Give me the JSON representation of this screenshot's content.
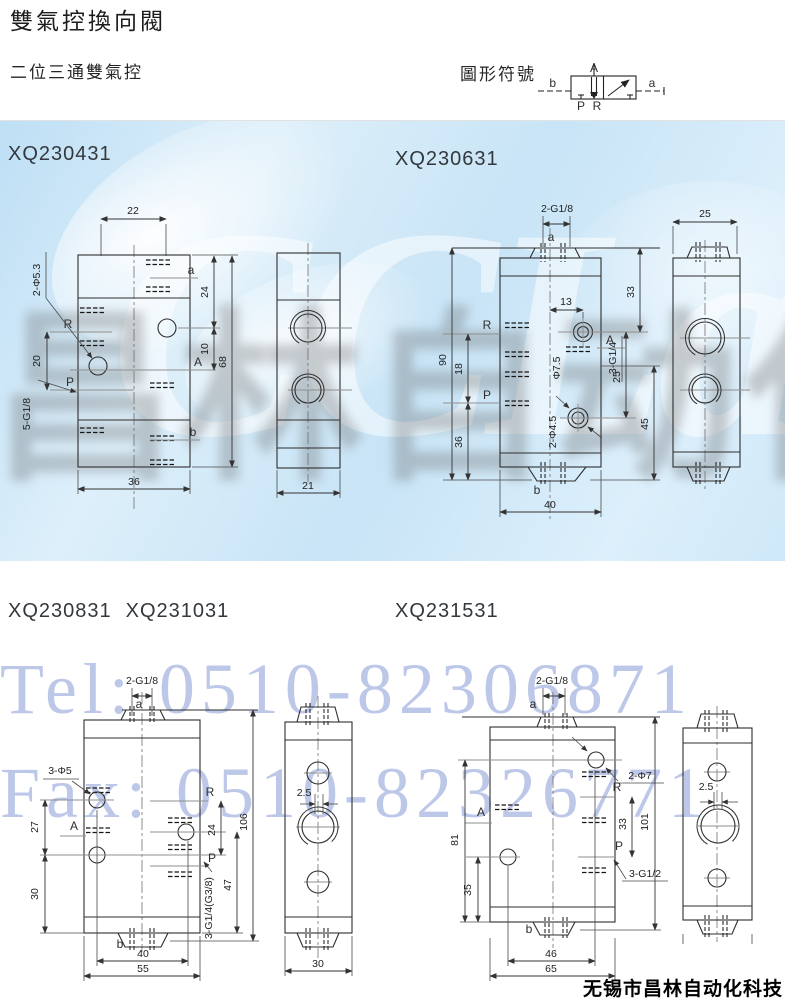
{
  "page": {
    "title": "雙氣控換向閥",
    "subtitle": "二位三通雙氣控",
    "symbol_title": "圖形符號",
    "footer": "无锡市昌林自动化科技",
    "watermark": {
      "tel": "Tel: 0510-82306871",
      "fax": "Fax: 0510-82326771",
      "brand": "CCLair",
      "brand_cn": "昌林自动化"
    }
  },
  "symbol": {
    "a": "a",
    "b": "b",
    "A": "A",
    "P": "P",
    "R": "R"
  },
  "models": [
    {
      "label": "XQ230431",
      "front": {
        "w_top": "22",
        "holes": "2-Φ5.3",
        "d24": "24",
        "d10": "10",
        "d68": "68",
        "d20": "20",
        "thread": "5-G1/8",
        "w_bot": "36",
        "R": "R",
        "P": "P",
        "A": "A",
        "a": "a",
        "b": "b"
      },
      "side": {
        "w": "21"
      }
    },
    {
      "label": "XQ230631",
      "front": {
        "top": "2-G1/8",
        "a": "a",
        "d33": "33",
        "d13": "13",
        "R": "R",
        "A": "A",
        "thread": "3-G1/4",
        "d25": "25",
        "d90": "90",
        "d18": "18",
        "P": "P",
        "cbore": "Φ7.5",
        "holes": "2-Φ4.5",
        "d36": "36",
        "d45": "45",
        "b": "b",
        "w_bot": "40"
      },
      "side": {
        "w": "25"
      }
    },
    {
      "label": "XQ230831",
      "label2": "XQ231031",
      "front": {
        "top": "2-G1/8",
        "a": "a",
        "holes": "3-Φ5",
        "d27": "27",
        "A": "A",
        "d30": "30",
        "R": "R",
        "d24": "24",
        "d106": "106",
        "P": "P",
        "d47": "47",
        "thread": "3-G1/4(G3/8)",
        "b": "b",
        "w40": "40",
        "w55": "55"
      },
      "side": {
        "offset": "2.5",
        "w": "30"
      }
    },
    {
      "label": "XQ231531",
      "front": {
        "top": "2-G1/8",
        "a": "a",
        "holes": "2-Φ7",
        "R": "R",
        "d33": "33",
        "d101": "101",
        "A": "A",
        "d81": "81",
        "d35": "35",
        "P": "P",
        "thread": "3-G1/2",
        "b": "b",
        "w46": "46",
        "w65": "65"
      },
      "side": {
        "offset": "2.5"
      }
    }
  ]
}
